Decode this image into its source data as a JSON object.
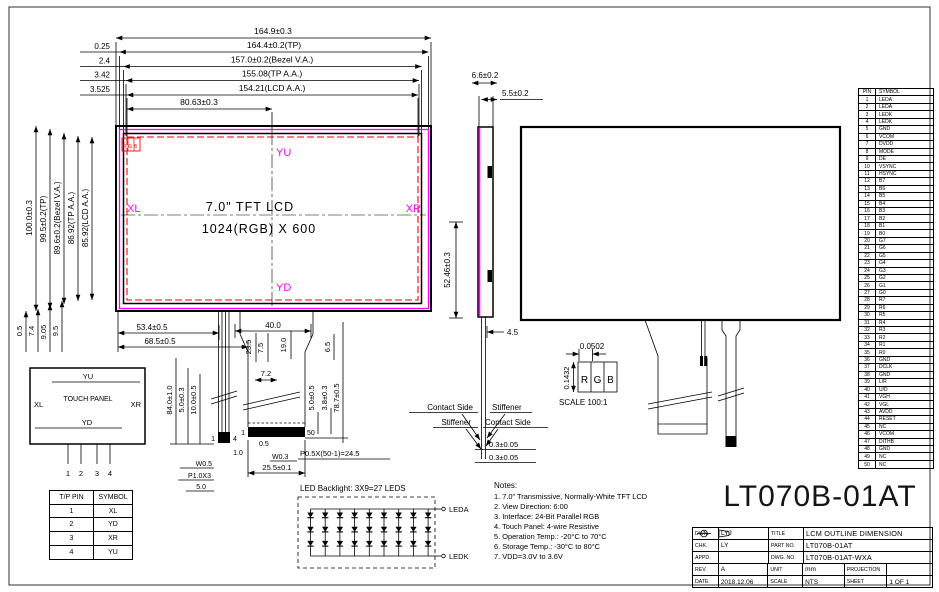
{
  "sheet": {
    "part_number_large": "LT070B-01AT"
  },
  "front_view": {
    "top_dims": [
      "164.9±0.3",
      "164.4±0.2(TP)",
      "157.0±0.2(Bezel V.A.)",
      "155.08(TP A.A.)",
      "154.21(LCD A.A.)",
      "80.63±0.3"
    ],
    "top_offsets": [
      "0.25",
      "2.4",
      "3.42",
      "3.525"
    ],
    "left_dims": [
      "100.0±0.3",
      "99.5±0.2(TP)",
      "89.6±0.2(Bezel V.A.)",
      "86.92(TP A.A.)",
      "85.92(LCD A.A.)"
    ],
    "bottom_offsets": [
      "0.5",
      "7.4",
      "9.05",
      "9.5"
    ],
    "right_dim": "52.46±0.3",
    "size_label": "7.0\" TFT LCD",
    "res_label": "1024(RGB) X 600",
    "dir_top": "YU",
    "dir_bottom": "YD",
    "dir_left": "XL",
    "dir_right": "XR",
    "rgb_mark": "RGB",
    "below_dims": [
      "53.4±0.5",
      "68.5±0.5",
      "40.0",
      "23.5",
      "7.5",
      "19.0",
      "6.5",
      "7.2"
    ]
  },
  "fpc": {
    "tp_tail_dims": [
      "84.0±1.0",
      "5.0±0.3",
      "10.0±0.5"
    ],
    "tp_pin_first": "1",
    "tp_pin_last": "4",
    "tp_width": "W0.5",
    "tp_pitch": "P1.0X3",
    "tp_len": "5.0",
    "gap": "1.0",
    "pin_first": "1",
    "pin_last": "50",
    "pad_edge": "0.5",
    "pad_width": "W0.3",
    "conn_width": "25.5±0.1",
    "pitch_eq": "P0.5X(50-1)=24.5",
    "right_dims": [
      "5.0±0.5",
      "3.8±0.3",
      "78.7±0.5"
    ]
  },
  "side_view": {
    "thk_total": "6.6±0.2",
    "thk_lcd": "5.5±0.2",
    "offset": "4.5",
    "contact_side": "Contact Side",
    "stiffener": "Stiffener",
    "tail_thk": "0.3±0.05"
  },
  "pixel_detail": {
    "w": "0.0502",
    "h": "0.1432",
    "r": "R",
    "g": "G",
    "b": "B",
    "scale": "SCALE 100:1"
  },
  "touch_panel": {
    "title": "TOUCH PANEL",
    "top": "YU",
    "bottom": "YD",
    "left": "XL",
    "right": "XR",
    "pins": [
      "1",
      "2",
      "3",
      "4"
    ]
  },
  "tp_table": {
    "headers": [
      "T/P PIN",
      "SYMBOL"
    ],
    "rows": [
      [
        "1",
        "XL"
      ],
      [
        "2",
        "YD"
      ],
      [
        "3",
        "XR"
      ],
      [
        "4",
        "YU"
      ]
    ]
  },
  "led": {
    "title": "LED Backlight: 3X9=27 LEDS",
    "anode": "LEDA",
    "cathode": "LEDK"
  },
  "notes": {
    "title": "Notes:",
    "items": [
      "1. 7.0\" Transmissive, Normally-White TFT LCD",
      "2. View Direction: 6:00",
      "3. Interface: 24-Bit Parallel RGB",
      "4. Touch Panel: 4-wire Resistive",
      "5. Operation Temp.: -20°C to 70°C",
      "6. Storage Temp.: -30°C to 80°C",
      "7. VDD=3.0V to 3.6V"
    ]
  },
  "pin_table": {
    "headers": [
      "PIN",
      "SYMBOL"
    ],
    "rows": [
      [
        "1",
        "LEDA"
      ],
      [
        "2",
        "LEDA"
      ],
      [
        "3",
        "LEDK"
      ],
      [
        "4",
        "LEDK"
      ],
      [
        "5",
        "GND"
      ],
      [
        "6",
        "VCOM"
      ],
      [
        "7",
        "DVDD"
      ],
      [
        "8",
        "MODE"
      ],
      [
        "9",
        "DE"
      ],
      [
        "10",
        "VSYNC"
      ],
      [
        "11",
        "HSYNC"
      ],
      [
        "12",
        "B7"
      ],
      [
        "13",
        "B6"
      ],
      [
        "14",
        "B5"
      ],
      [
        "15",
        "B4"
      ],
      [
        "16",
        "B3"
      ],
      [
        "17",
        "B2"
      ],
      [
        "18",
        "B1"
      ],
      [
        "19",
        "B0"
      ],
      [
        "20",
        "G7"
      ],
      [
        "21",
        "G6"
      ],
      [
        "22",
        "G5"
      ],
      [
        "23",
        "G4"
      ],
      [
        "24",
        "G3"
      ],
      [
        "25",
        "G2"
      ],
      [
        "26",
        "G1"
      ],
      [
        "27",
        "G0"
      ],
      [
        "28",
        "R7"
      ],
      [
        "29",
        "R6"
      ],
      [
        "30",
        "R5"
      ],
      [
        "31",
        "R4"
      ],
      [
        "32",
        "R3"
      ],
      [
        "33",
        "R2"
      ],
      [
        "34",
        "R1"
      ],
      [
        "35",
        "R0"
      ],
      [
        "36",
        "GND"
      ],
      [
        "37",
        "DCLK"
      ],
      [
        "38",
        "GND"
      ],
      [
        "39",
        "L/R"
      ],
      [
        "40",
        "U/D"
      ],
      [
        "41",
        "VGH"
      ],
      [
        "42",
        "VGL"
      ],
      [
        "43",
        "AVDD"
      ],
      [
        "44",
        "RESET"
      ],
      [
        "45",
        "NC"
      ],
      [
        "46",
        "VCOM"
      ],
      [
        "47",
        "DITHB"
      ],
      [
        "48",
        "GND"
      ],
      [
        "49",
        "NC"
      ],
      [
        "50",
        "NC"
      ]
    ]
  },
  "title_block": {
    "dwn_label": "DWN.",
    "dwn": "LYJ",
    "title_label": "TITLE",
    "title": "LCM OUTLINE DIMENSION",
    "chk_label": "CHK.",
    "chk": "LY",
    "part_label": "PART NO.",
    "part": "LT070B-01AT",
    "appd_label": "APPD.",
    "appd": "",
    "dwg_label": "DWG. NO.",
    "dwg": "LT070B-01AT-WXA",
    "rev_label": "REV.",
    "rev": "A",
    "unit_label": "UNIT",
    "unit": "mm",
    "proj_label": "PROJECTION",
    "date_label": "DATE",
    "date": "2018.12.06",
    "scale_label": "SCALE",
    "scale": "NTS",
    "sheet_label": "SHEET",
    "sheet": "1  OF  1"
  }
}
